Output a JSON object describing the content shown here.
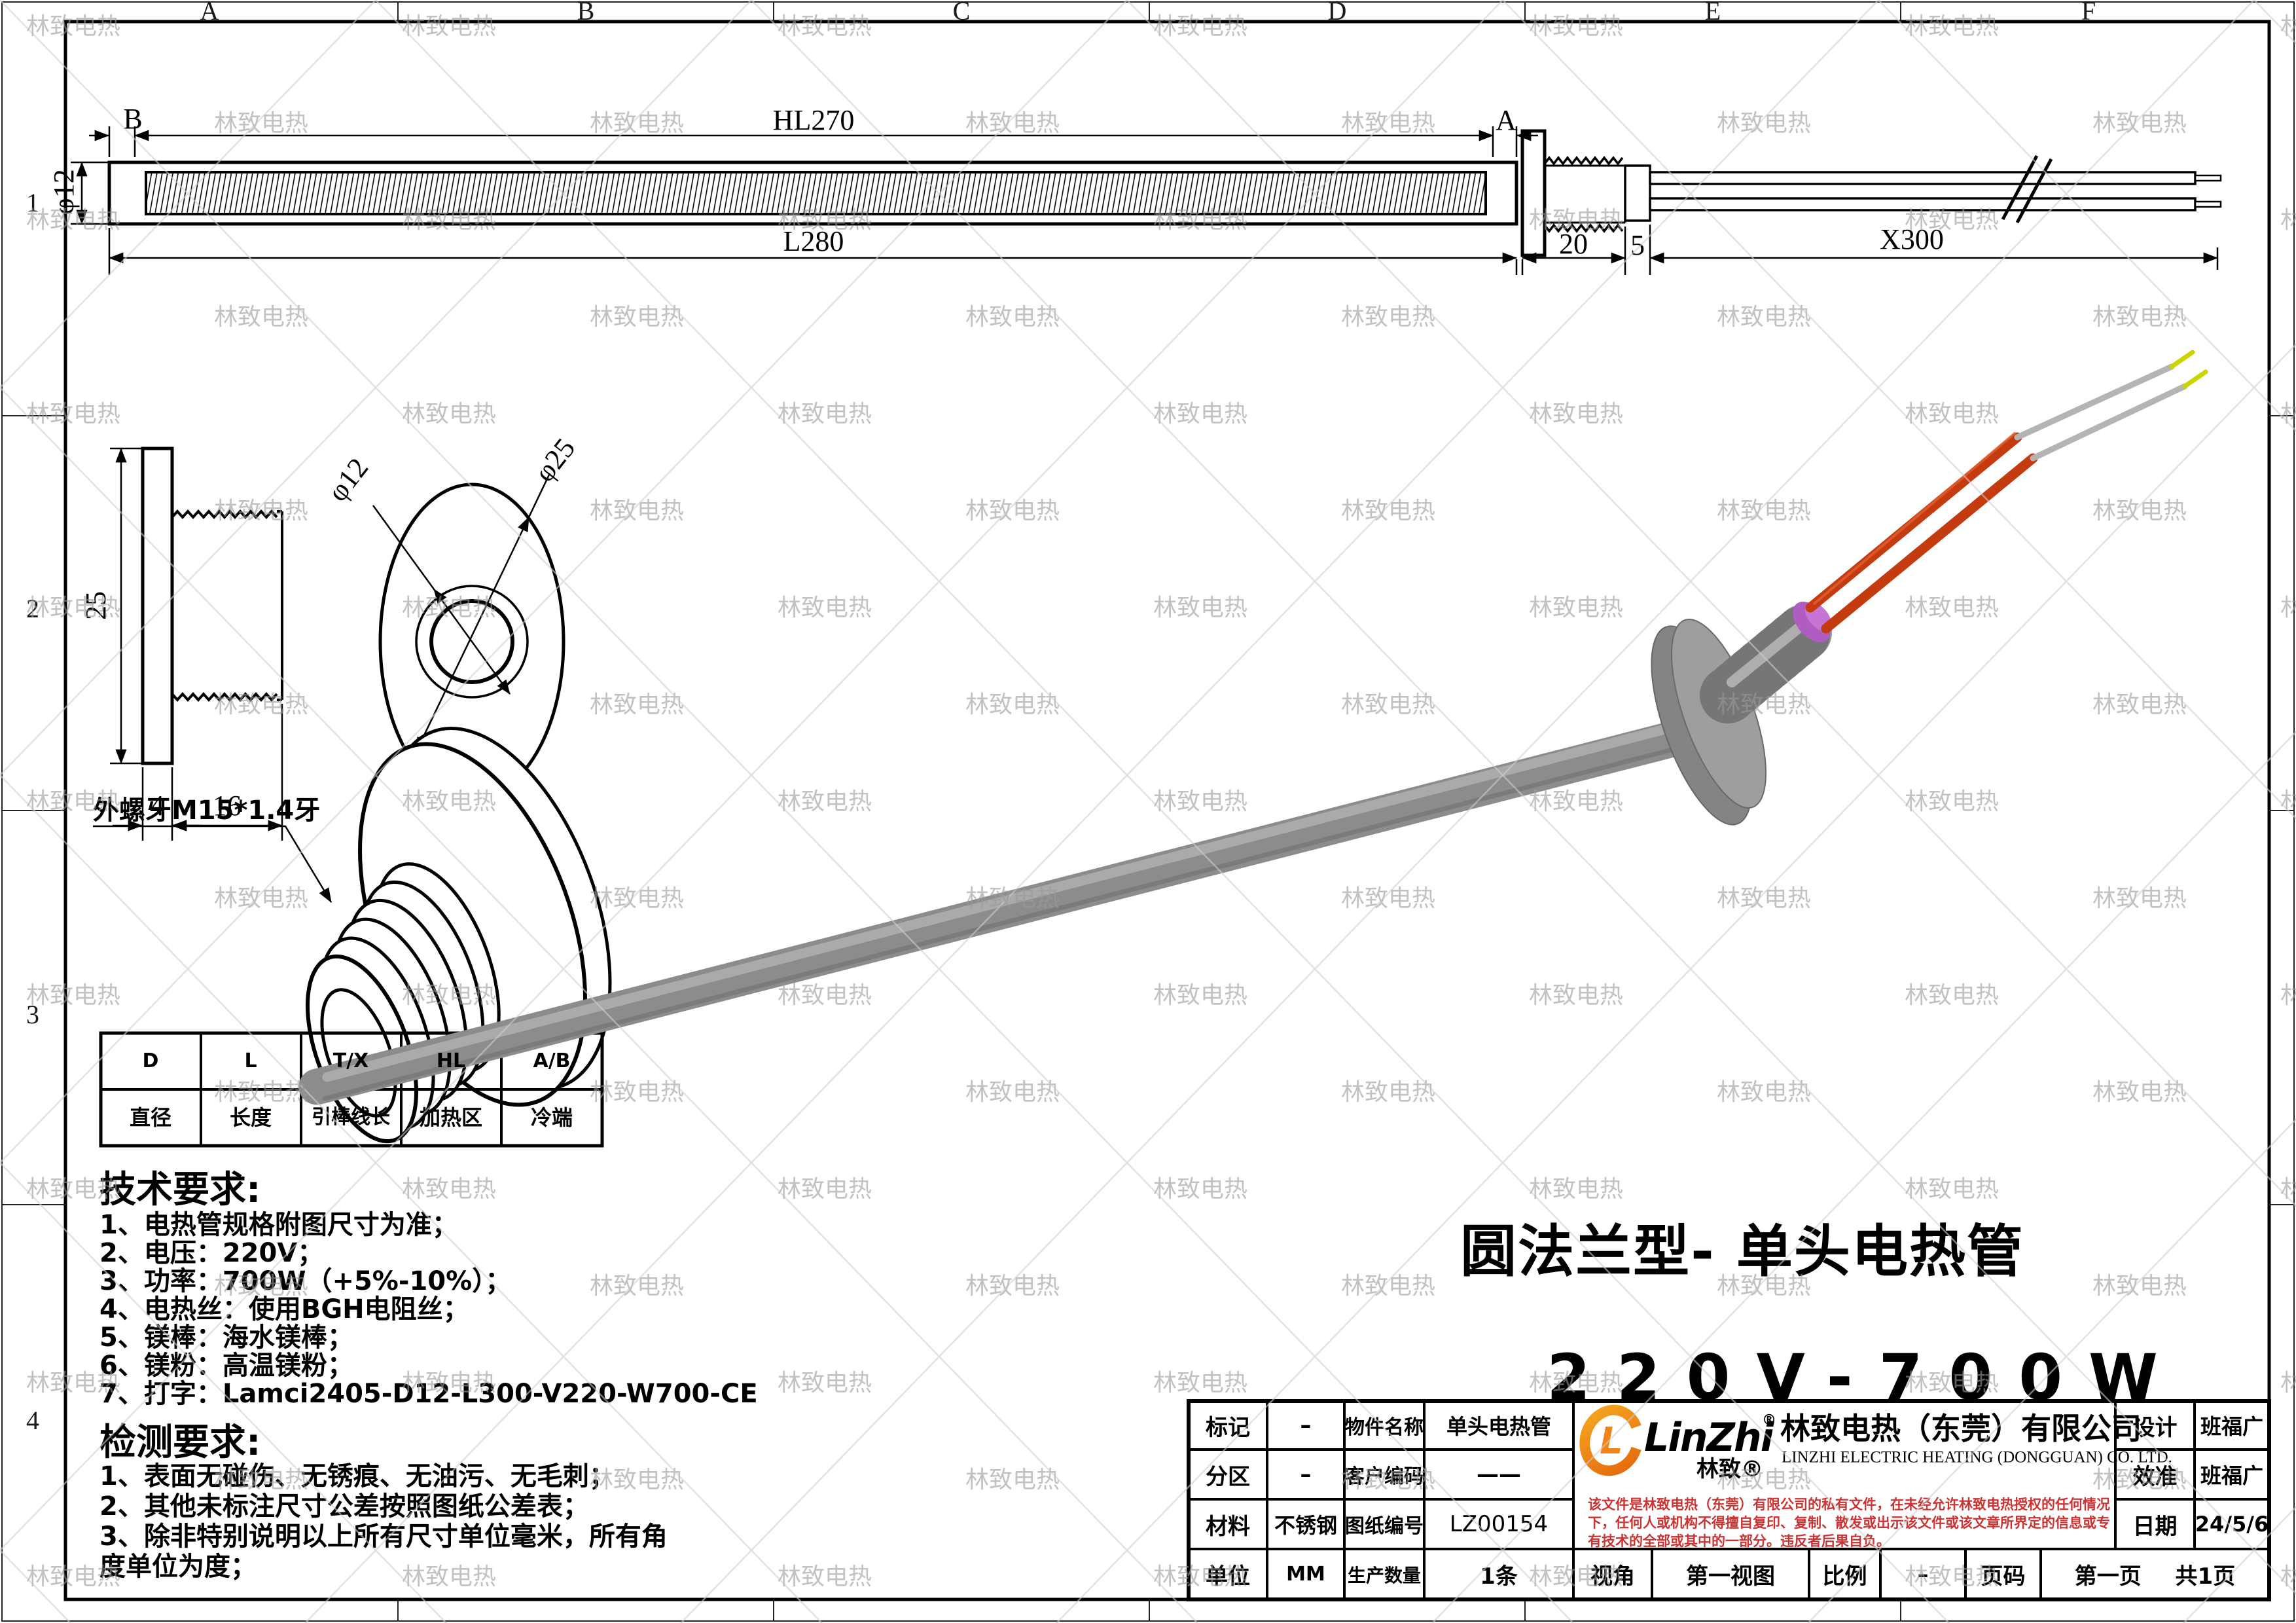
{
  "watermark": {
    "text": "林致电热"
  },
  "frame": {
    "top_zones": [
      "A",
      "B",
      "C",
      "D",
      "E",
      "F"
    ],
    "left_zones": [
      "1",
      "2",
      "3",
      "4"
    ]
  },
  "top_view": {
    "dim_b": "B",
    "dim_a": "A",
    "dim_hl": "HL270",
    "dim_l": "L280",
    "dim_diameter": "φ12",
    "dim_thread": "20",
    "dim_step": "5",
    "dim_wire": "X300"
  },
  "side_view": {
    "dim_height": "25",
    "dim_plate": "4",
    "dim_thread": "16"
  },
  "front_view": {
    "dim_inner": "φ12",
    "dim_outer": "φ25"
  },
  "thread_detail": {
    "label": "外螺牙M15*1.4牙"
  },
  "param_table": {
    "headers": [
      "D",
      "L",
      "T/X",
      "HL",
      "A/B"
    ],
    "meanings": [
      "直径",
      "长度",
      "引棒线长",
      "加热区",
      "冷端"
    ]
  },
  "tech_requirements": {
    "title": "技术要求:",
    "items": [
      "1、电热管规格附图尺寸为准；",
      "2、电压：220V；",
      "3、功率：700W（+5%-10%）；",
      "4、电热丝：使用BGH电阻丝；",
      "5、镁棒：海水镁棒；",
      "6、镁粉：高温镁粉；",
      "7、打字：Lamci2405-D12-L300-V220-W700-CE"
    ]
  },
  "inspection_requirements": {
    "title": "检测要求:",
    "lines": [
      "1、表面无碰伤、无锈痕、无油污、无毛刺；",
      "2、其他未标注尺寸公差按照图纸公差表；",
      "3、除非特别说明以上所有尺寸单位毫米，所有角",
      "度单位为度；"
    ]
  },
  "product": {
    "type_title": "圆法兰型- 单头电热管",
    "spec": "220V-700W"
  },
  "title_block": {
    "mark_label": "标记",
    "mark_value": "–",
    "part_name_label": "物件名称",
    "part_name_value": "单头电热管",
    "zone_label": "分区",
    "zone_value": "–",
    "customer_code_label": "客户编码",
    "customer_code_value": "——",
    "material_label": "材料",
    "material_value": "不锈钢",
    "drawing_no_label": "图纸编号",
    "drawing_no_value": "LZ00154",
    "unit_label": "单位",
    "unit_value": "MM",
    "quantity_label": "生产数量",
    "quantity_value": "1条",
    "view_label": "视角",
    "view_value": "第一视图",
    "scale_label": "比例",
    "scale_value": "–",
    "page_label": "页码",
    "page_first": "第一页",
    "page_total": "共1页",
    "design_label": "设计",
    "design_value": "班福广",
    "check_label": "效准",
    "check_value": "班福广",
    "date_label": "日期",
    "date_value": "24/5/6",
    "company": {
      "logo_mark": "L",
      "logo_text": "LinZhi",
      "logo_reg": "®",
      "logo_sub": "林致®",
      "name_cn": "林致电热（东莞）有限公司",
      "name_en": "LINZHI ELECTRIC HEATING (DONGGUAN) CO. LTD.",
      "accent": "#f08418",
      "disclaimer_color": "#cc3333",
      "disclaimer_lines": [
        "该文件是林致电热（东莞）有限公司的私有文件，在未经允许林致电热授权的任何情况",
        "下，任何人或机构不得擅自复印、复制、散发或出示该文件或该文章所界定的信息或专",
        "有技术的全部或其中的一部分。违反者后果自负。"
      ]
    }
  }
}
